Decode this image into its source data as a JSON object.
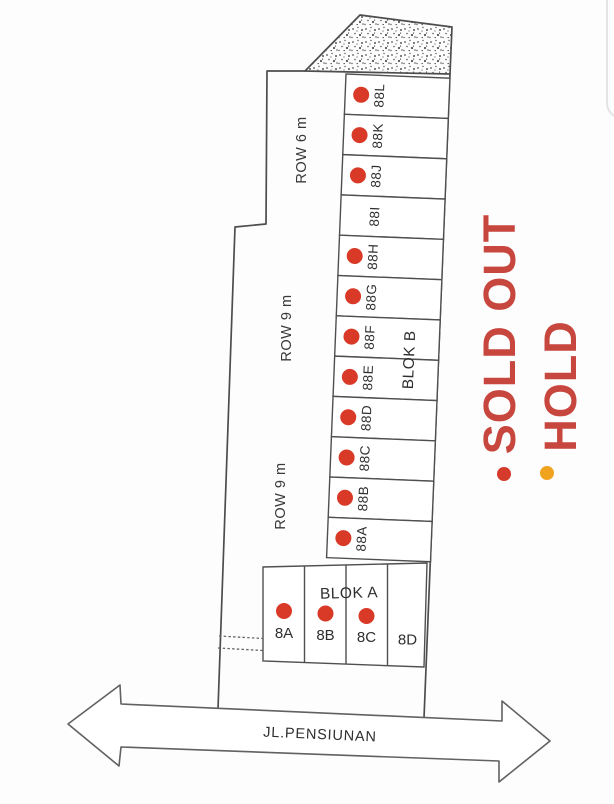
{
  "diagram": {
    "rows": [
      {
        "label": "ROW 6 m"
      },
      {
        "label": "ROW 9 m"
      },
      {
        "label": "ROW 9 m"
      }
    ],
    "blok_b": {
      "label": "BLOK B",
      "lots": [
        {
          "id": "88L",
          "status": "sold"
        },
        {
          "id": "88K",
          "status": "sold"
        },
        {
          "id": "88J",
          "status": "sold"
        },
        {
          "id": "88I",
          "status": "available"
        },
        {
          "id": "88H",
          "status": "sold"
        },
        {
          "id": "88G",
          "status": "sold"
        },
        {
          "id": "88F",
          "status": "sold"
        },
        {
          "id": "88E",
          "status": "sold"
        },
        {
          "id": "88D",
          "status": "sold"
        },
        {
          "id": "88C",
          "status": "sold"
        },
        {
          "id": "88B",
          "status": "sold"
        },
        {
          "id": "88A",
          "status": "sold"
        }
      ]
    },
    "blok_a": {
      "label": "BLOK A",
      "lots": [
        {
          "id": "8A",
          "status": "sold"
        },
        {
          "id": "8B",
          "status": "sold"
        },
        {
          "id": "8C",
          "status": "sold"
        },
        {
          "id": "8D",
          "status": "available"
        }
      ]
    },
    "road": {
      "label": "JL.PENSIUNAN"
    },
    "legend": [
      {
        "label": "SOLD OUT",
        "status": "sold",
        "text_color": "#c7473e",
        "dot_color": "#d53a2a"
      },
      {
        "label": "HOLD",
        "status": "hold",
        "text_color": "#c7473e",
        "dot_color": "#efa31f"
      }
    ],
    "colors": {
      "sold_dot": "#d93a28",
      "hold_dot": "#efa31f",
      "line": "#4f4f4f",
      "legend_text": "#c7473e"
    }
  }
}
